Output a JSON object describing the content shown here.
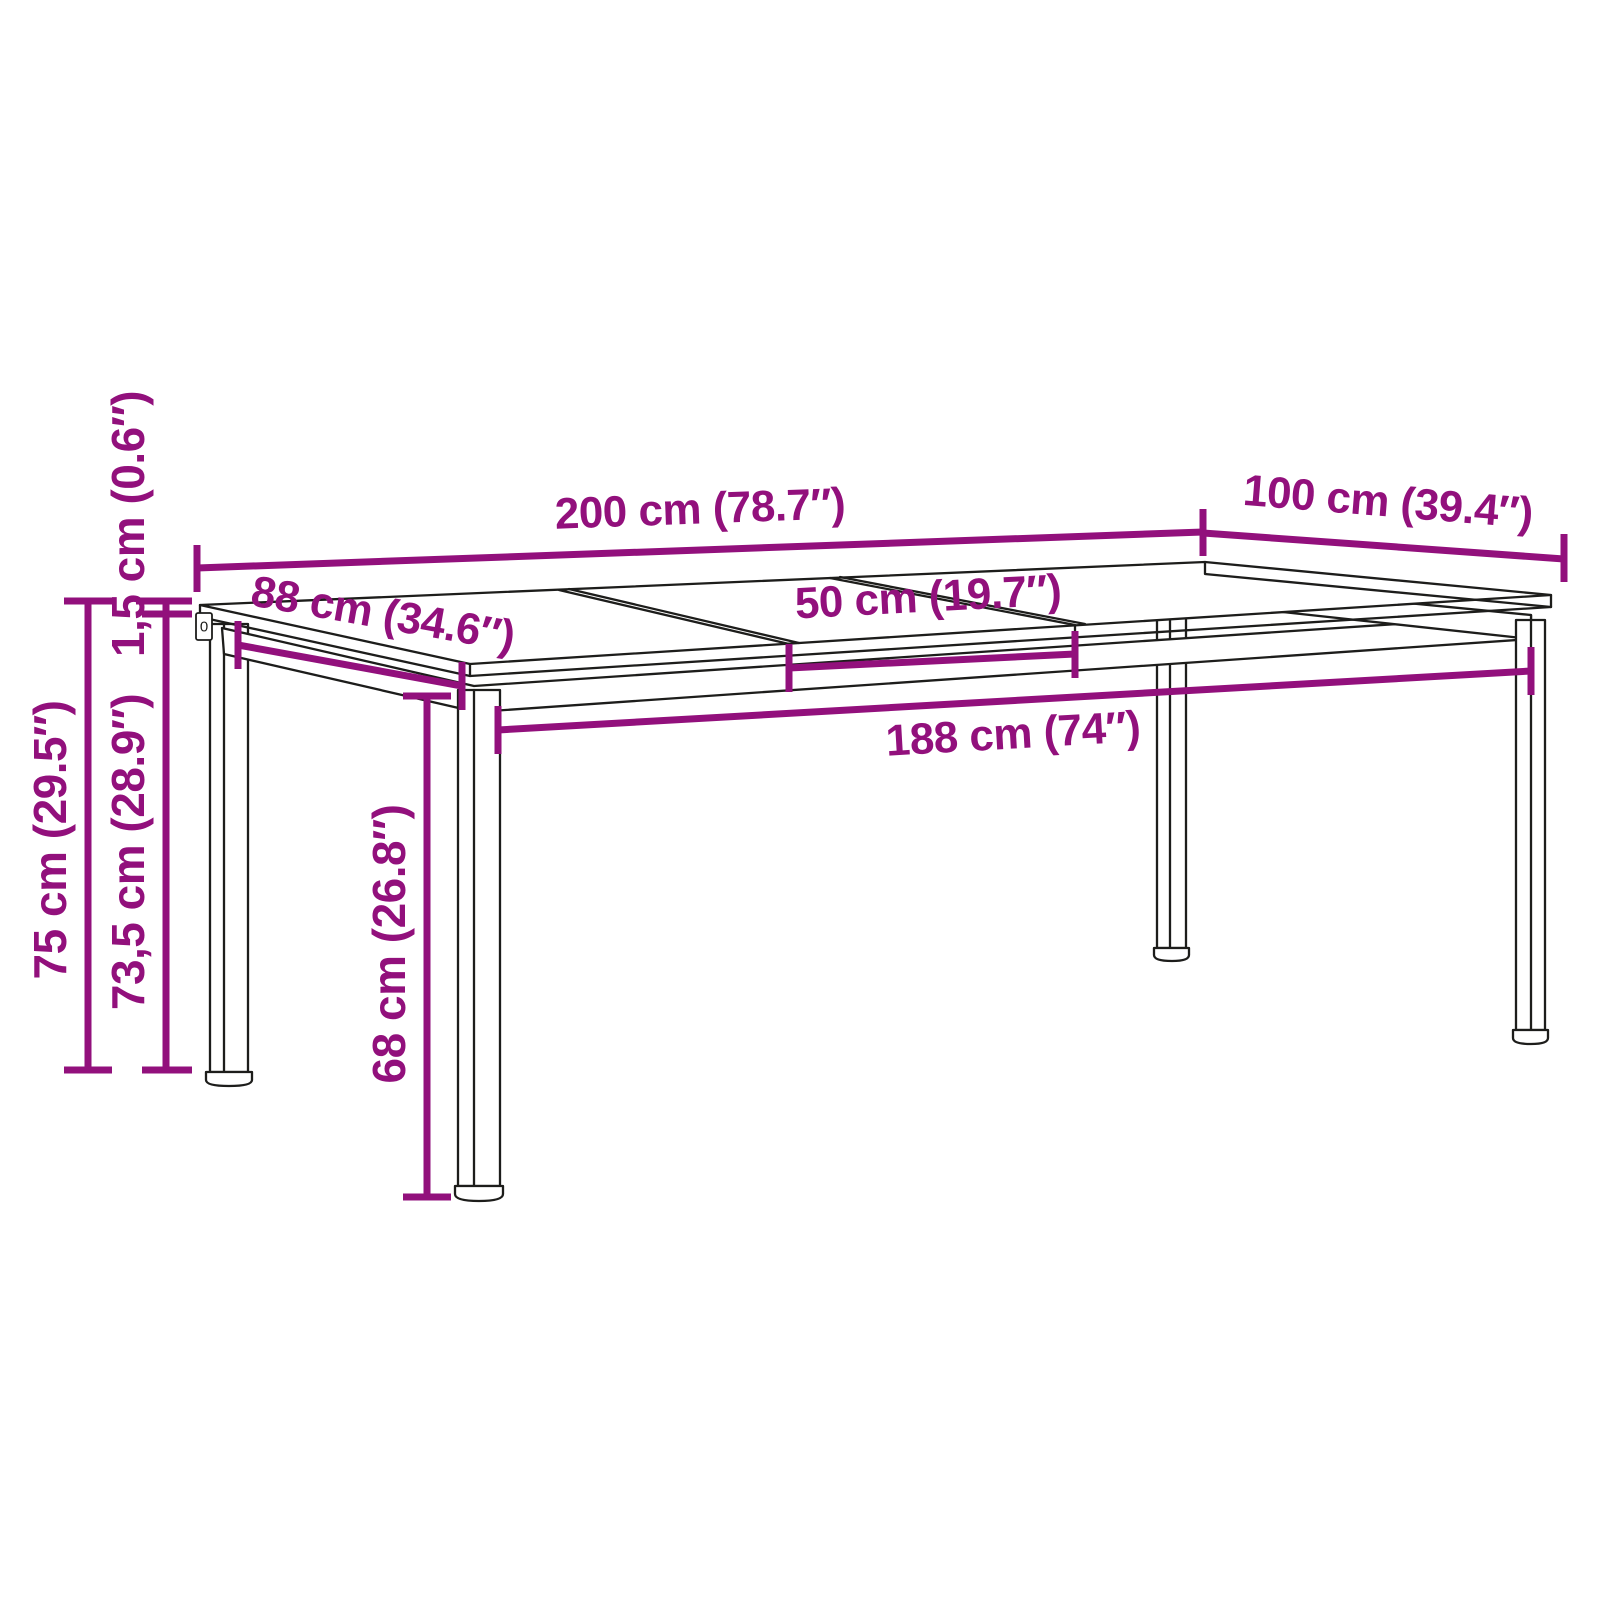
{
  "diagram": {
    "product": "extendable-dining-table-dimension-diagram",
    "background_color": "#ffffff",
    "outline_color": "#1d1d1b",
    "dimension_color": "#92107C",
    "labels": {
      "top_length": "200 cm (78.7″)",
      "top_width": "100 cm (39.4″)",
      "left_leg_spacing_depth": "88 cm (34.6″)",
      "extension_leaf_width": "50 cm (19.7″)",
      "leg_spacing_length": "188 cm (74″)",
      "total_height": "75 cm (29.5″)",
      "height_to_underside": "73,5 cm (28.9″)",
      "tabletop_thickness": "1,5 cm (0.6″)",
      "leg_clearance_height": "68 cm (26.8″)",
      "leg_plate_mark": "0"
    }
  }
}
